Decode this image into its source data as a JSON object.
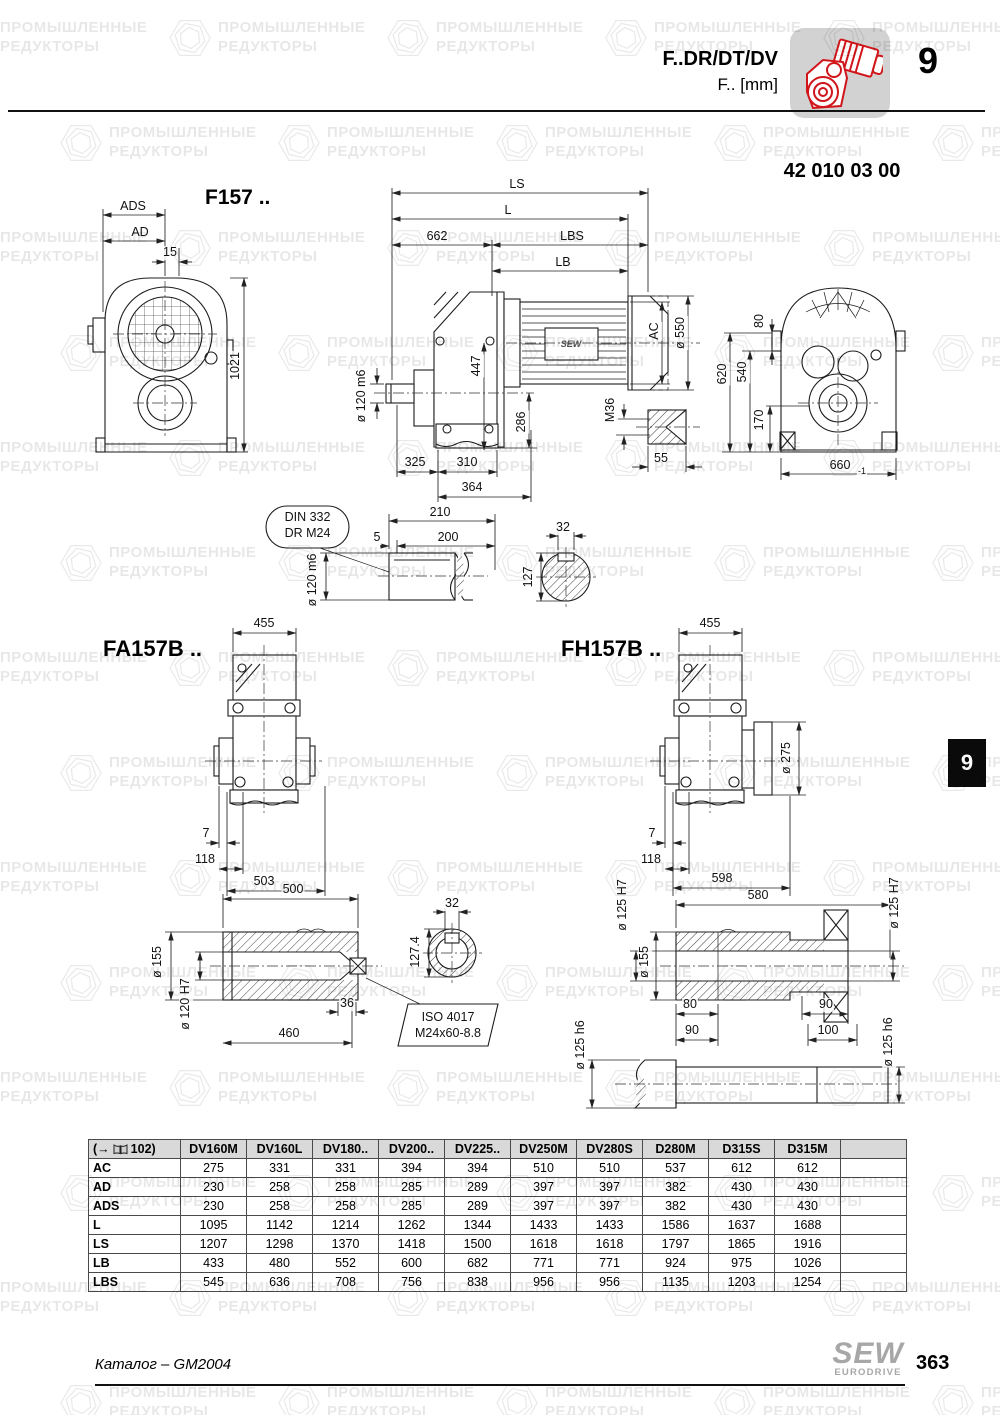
{
  "header": {
    "model_line": "F..DR/DT/DV",
    "unit_line": "F.. [mm]",
    "chapter": "9",
    "part_number": "42 010 03 00"
  },
  "side_tab": {
    "label": "9"
  },
  "colors": {
    "accent_red": "#d1161b",
    "icon_box_gray": "#d2d2d2",
    "tab_black": "#0a0a0a",
    "table_header_gray": "#d9d9d9",
    "brand_gray": "#a7a7a7"
  },
  "watermark": {
    "line1": "ПРОМЫШЛЕННЫЕ",
    "line2": "РЕДУКТОРЫ"
  },
  "drawings": {
    "f157": {
      "title": "F157 .."
    },
    "fa157b": {
      "title": "FA157B .."
    },
    "fh157b": {
      "title": "FH157B .."
    },
    "motor_brand": "SEW",
    "din_balloon": {
      "line1": "DIN 332",
      "line2": "DR M24"
    },
    "iso_balloon": {
      "line1": "ISO 4017",
      "line2": "M24x60-8.8"
    }
  },
  "labels": [
    {
      "t": "ADS",
      "x": 133,
      "y": 207
    },
    {
      "t": "AD",
      "x": 140,
      "y": 233
    },
    {
      "t": "15",
      "x": 170,
      "y": 253
    },
    {
      "t": "1021",
      "x": 236,
      "y": 366,
      "r": -90
    },
    {
      "t": "ø 120 m6",
      "x": 362,
      "y": 396,
      "r": -90
    },
    {
      "t": "LS",
      "x": 517,
      "y": 185
    },
    {
      "t": "L",
      "x": 508,
      "y": 211
    },
    {
      "t": "662",
      "x": 437,
      "y": 237
    },
    {
      "t": "LBS",
      "x": 572,
      "y": 237
    },
    {
      "t": "LB",
      "x": 563,
      "y": 263
    },
    {
      "t": "447",
      "x": 477,
      "y": 366,
      "r": -90
    },
    {
      "t": "AC",
      "x": 655,
      "y": 331,
      "r": -90
    },
    {
      "t": "ø 550",
      "x": 681,
      "y": 333,
      "r": -90
    },
    {
      "t": "286",
      "x": 522,
      "y": 422,
      "r": -90
    },
    {
      "t": "M36",
      "x": 611,
      "y": 410,
      "r": -90
    },
    {
      "t": "55",
      "x": 661,
      "y": 459
    },
    {
      "t": "325",
      "x": 415,
      "y": 463
    },
    {
      "t": "310",
      "x": 467,
      "y": 463
    },
    {
      "t": "364",
      "x": 472,
      "y": 488
    },
    {
      "t": "80",
      "x": 760,
      "y": 321,
      "r": -90
    },
    {
      "t": "620",
      "x": 723,
      "y": 374,
      "r": -90
    },
    {
      "t": "540",
      "x": 743,
      "y": 372,
      "r": -90
    },
    {
      "t": "170",
      "x": 760,
      "y": 420,
      "r": -90
    },
    {
      "t": "660",
      "x": 840,
      "y": 466
    },
    {
      "t": "-1",
      "x": 862,
      "y": 472,
      "fs": 9
    },
    {
      "t": "210",
      "x": 440,
      "y": 513
    },
    {
      "t": "5",
      "x": 377,
      "y": 538
    },
    {
      "t": "200",
      "x": 448,
      "y": 538
    },
    {
      "t": "ø 120 m6",
      "x": 313,
      "y": 580,
      "r": -90
    },
    {
      "t": "32",
      "x": 563,
      "y": 528
    },
    {
      "t": "127",
      "x": 529,
      "y": 577,
      "r": -90
    },
    {
      "t": "455",
      "x": 264,
      "y": 624
    },
    {
      "t": "7",
      "x": 206,
      "y": 834
    },
    {
      "t": "118",
      "x": 205,
      "y": 860
    },
    {
      "t": "503",
      "x": 264,
      "y": 882
    },
    {
      "t": "500",
      "x": 293,
      "y": 890
    },
    {
      "t": "ø 155",
      "x": 158,
      "y": 962,
      "r": -90
    },
    {
      "t": "ø 120 H7",
      "x": 186,
      "y": 1004,
      "r": -90
    },
    {
      "t": "36",
      "x": 347,
      "y": 1004
    },
    {
      "t": "460",
      "x": 289,
      "y": 1034
    },
    {
      "t": "32",
      "x": 452,
      "y": 904
    },
    {
      "t": "127.4",
      "x": 416,
      "y": 952,
      "r": -90
    },
    {
      "t": "455",
      "x": 710,
      "y": 624
    },
    {
      "t": "ø 275",
      "x": 787,
      "y": 758,
      "r": -90
    },
    {
      "t": "7",
      "x": 652,
      "y": 834
    },
    {
      "t": "118",
      "x": 651,
      "y": 860
    },
    {
      "t": "598",
      "x": 722,
      "y": 879
    },
    {
      "t": "580",
      "x": 758,
      "y": 896
    },
    {
      "t": "ø 125 H7",
      "x": 623,
      "y": 905,
      "r": -90
    },
    {
      "t": "ø 155",
      "x": 645,
      "y": 962,
      "r": -90
    },
    {
      "t": "ø 125 H7",
      "x": 895,
      "y": 903,
      "r": -90
    },
    {
      "t": "80",
      "x": 690,
      "y": 1005
    },
    {
      "t": "90",
      "x": 826,
      "y": 1005
    },
    {
      "t": "90",
      "x": 692,
      "y": 1031
    },
    {
      "t": "100",
      "x": 828,
      "y": 1031
    },
    {
      "t": "ø 125 h6",
      "x": 581,
      "y": 1045,
      "r": -90
    },
    {
      "t": "ø 125 h6",
      "x": 889,
      "y": 1042,
      "r": -90
    }
  ],
  "table": {
    "ref_prefix": "(→",
    "ref_suffix": "102)",
    "columns": [
      "DV160M",
      "DV160L",
      "DV180..",
      "DV200..",
      "DV225..",
      "DV250M",
      "DV280S",
      "D280M",
      "D315S",
      "D315M",
      ""
    ],
    "rows": [
      {
        "label": "AC",
        "values": [
          275,
          331,
          331,
          394,
          394,
          510,
          510,
          537,
          612,
          612
        ]
      },
      {
        "label": "AD",
        "values": [
          230,
          258,
          258,
          285,
          289,
          397,
          397,
          382,
          430,
          430
        ]
      },
      {
        "label": "ADS",
        "values": [
          230,
          258,
          258,
          285,
          289,
          397,
          397,
          382,
          430,
          430
        ]
      },
      {
        "label": "L",
        "values": [
          1095,
          1142,
          1214,
          1262,
          1344,
          1433,
          1433,
          1586,
          1637,
          1688
        ]
      },
      {
        "label": "LS",
        "values": [
          1207,
          1298,
          1370,
          1418,
          1500,
          1618,
          1618,
          1797,
          1865,
          1916
        ]
      },
      {
        "label": "LB",
        "values": [
          433,
          480,
          552,
          600,
          682,
          771,
          771,
          924,
          975,
          1026
        ]
      },
      {
        "label": "LBS",
        "values": [
          545,
          636,
          708,
          756,
          838,
          956,
          956,
          1135,
          1203,
          1254
        ]
      }
    ]
  },
  "footer": {
    "catalog": "Каталог – GM2004",
    "page": "363",
    "brand": "SEW",
    "brand_sub": "EURODRIVE"
  }
}
